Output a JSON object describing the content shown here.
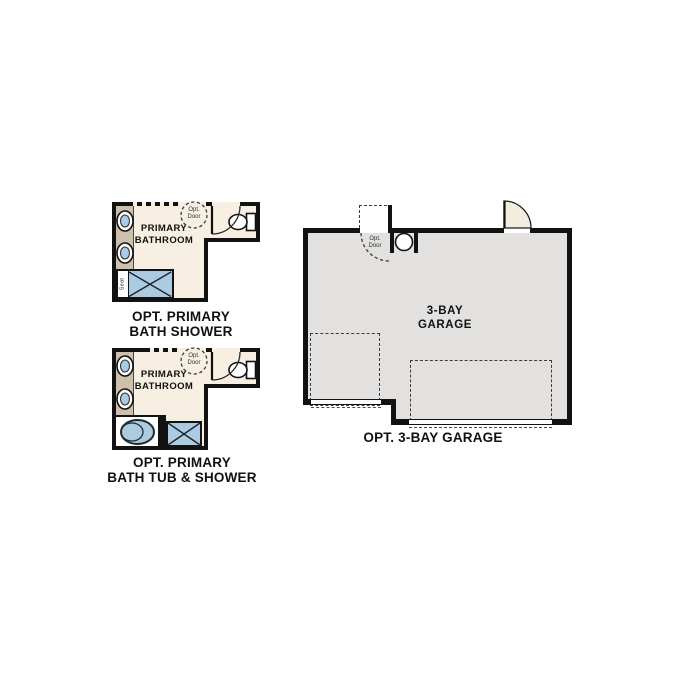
{
  "colors": {
    "wall": "#121212",
    "bath_floor": "#f6efe2",
    "vanity": "#cdc1ad",
    "fixture_blue": "#abcbe3",
    "garage_floor": "#e2e1df",
    "door_fill": "#f4ecdf",
    "text": "#111111"
  },
  "plans": {
    "bath_shower": {
      "room_label": [
        "PRIMARY",
        "BATHROOM"
      ],
      "opt_door_label": [
        "Opt.",
        "Door"
      ],
      "seat_label": "Seat",
      "caption": [
        "OPT. PRIMARY",
        "BATH SHOWER"
      ]
    },
    "bath_tub_shower": {
      "room_label": [
        "PRIMARY",
        "BATHROOM"
      ],
      "opt_door_label": [
        "Opt.",
        "Door"
      ],
      "caption": [
        "OPT. PRIMARY",
        "BATH TUB & SHOWER"
      ]
    },
    "garage": {
      "room_label": [
        "3-BAY",
        "GARAGE"
      ],
      "opt_door_label": [
        "Opt.",
        "Door"
      ],
      "water_heater_label": "WH",
      "caption": "OPT. 3-BAY GARAGE"
    }
  }
}
